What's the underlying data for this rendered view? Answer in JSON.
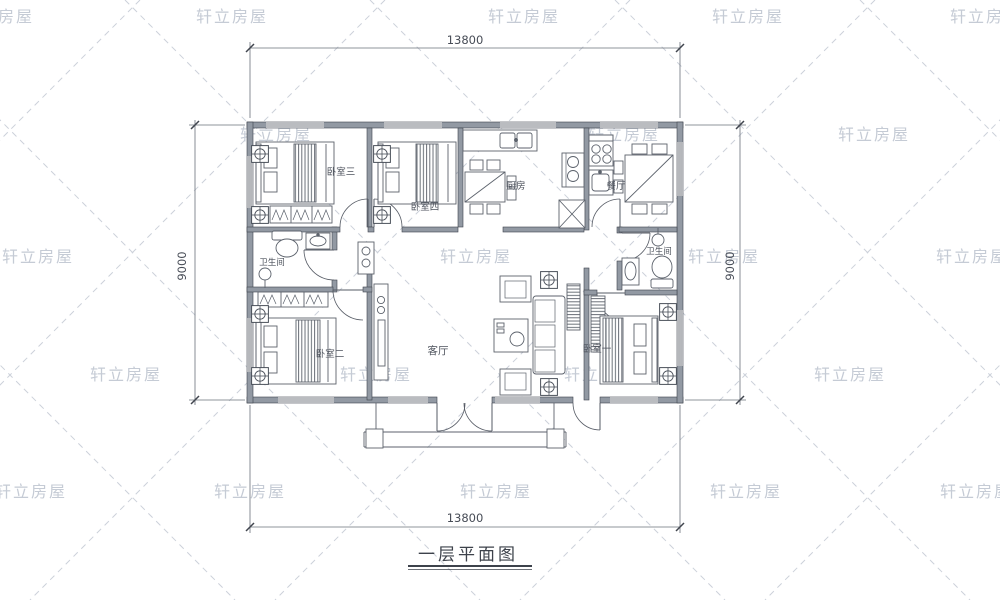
{
  "watermark": {
    "text": "轩立房屋",
    "positions": [
      [
        -38,
        8
      ],
      [
        196,
        8
      ],
      [
        488,
        8
      ],
      [
        712,
        8
      ],
      [
        950,
        8
      ],
      [
        240,
        126
      ],
      [
        588,
        126
      ],
      [
        838,
        126
      ],
      [
        2,
        248
      ],
      [
        440,
        248
      ],
      [
        688,
        248
      ],
      [
        936,
        248
      ],
      [
        90,
        366
      ],
      [
        340,
        366
      ],
      [
        564,
        366
      ],
      [
        814,
        366
      ],
      [
        -5,
        483
      ],
      [
        214,
        483
      ],
      [
        460,
        483
      ],
      [
        710,
        483
      ],
      [
        940,
        483
      ]
    ]
  },
  "title": "一层平面图",
  "dimensions": {
    "top": "13800",
    "bottom": "13800",
    "left": "9000",
    "right": "9000"
  },
  "rooms": {
    "bedroom3": "卧室三",
    "bedroom4": "卧室四",
    "kitchen": "厨房",
    "dining": "餐厅",
    "bathroom_left": "卫生间",
    "bathroom_right": "卫生间",
    "living": "客厅",
    "bedroom2": "卧室二",
    "bedroom1": "卧室一"
  },
  "colors": {
    "watermark": "#c5cbd5",
    "lattice": "#ccd1da",
    "wall": "#9299a3",
    "wall_edge": "#3f444d",
    "line": "#5c626c",
    "dim": "#474c56"
  }
}
